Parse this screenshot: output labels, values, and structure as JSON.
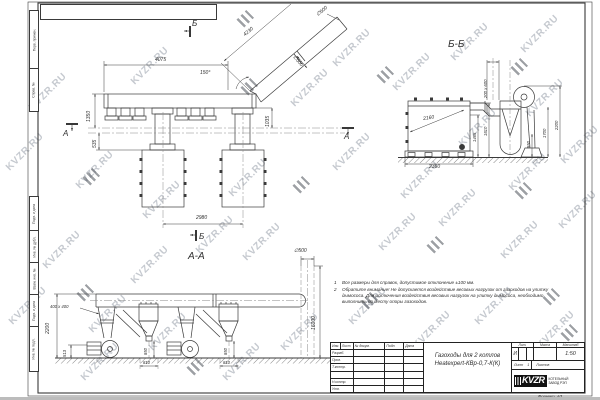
{
  "watermark": {
    "text": "KVZR.RU",
    "color": "#b7bcc4",
    "positions": [
      [
        48,
        92
      ],
      [
        25,
        152
      ],
      [
        95,
        170
      ],
      [
        62,
        250
      ],
      [
        28,
        306
      ],
      [
        108,
        314
      ],
      [
        162,
        200
      ],
      [
        150,
        265
      ],
      [
        215,
        235
      ],
      [
        150,
        66
      ],
      [
        248,
        178
      ],
      [
        262,
        242
      ],
      [
        310,
        88
      ],
      [
        352,
        48
      ],
      [
        412,
        72
      ],
      [
        470,
        42
      ],
      [
        540,
        34
      ],
      [
        352,
        152
      ],
      [
        420,
        180
      ],
      [
        478,
        128
      ],
      [
        545,
        98
      ],
      [
        528,
        172
      ],
      [
        580,
        145
      ],
      [
        398,
        232
      ],
      [
        458,
        208
      ],
      [
        520,
        240
      ],
      [
        578,
        210
      ],
      [
        300,
        332
      ],
      [
        368,
        306
      ],
      [
        432,
        330
      ],
      [
        494,
        306
      ],
      [
        556,
        330
      ],
      [
        242,
        362
      ],
      [
        168,
        332
      ],
      [
        100,
        362
      ]
    ]
  },
  "stamps": {
    "positions": [
      [
        250,
        86
      ],
      [
        386,
        74
      ],
      [
        520,
        66
      ],
      [
        92,
        176
      ],
      [
        302,
        184
      ],
      [
        524,
        190
      ],
      [
        436,
        244
      ],
      [
        86,
        292
      ],
      [
        370,
        300
      ],
      [
        552,
        296
      ],
      [
        196,
        366
      ],
      [
        440,
        352
      ],
      [
        570,
        332
      ],
      [
        246,
        18
      ]
    ]
  },
  "frame": {
    "margin_boxes": [
      {
        "text": "Перв. примен.",
        "top": 10,
        "h": 58
      },
      {
        "text": "Справ. №",
        "top": 68,
        "h": 42
      },
      {
        "text": "Подп. и дата",
        "top": 196,
        "h": 34
      },
      {
        "text": "Инв. № дубл.",
        "top": 230,
        "h": 32
      },
      {
        "text": "Взам. инв. №",
        "top": 262,
        "h": 32
      },
      {
        "text": "Подп. и дата",
        "top": 294,
        "h": 32
      },
      {
        "text": "Инв. № подл.",
        "top": 326,
        "h": 44
      }
    ]
  },
  "labels": [
    {
      "t": "Б",
      "x": 192,
      "y": 20,
      "s": 8,
      "n": "section-marker-b-top"
    },
    {
      "t": "Б",
      "x": 199,
      "y": 233,
      "s": 8,
      "n": "section-marker-b-bottom"
    },
    {
      "t": "А",
      "x": 63,
      "y": 130,
      "s": 8,
      "n": "section-marker-a-left"
    },
    {
      "t": "А",
      "x": 344,
      "y": 133,
      "s": 8,
      "n": "section-marker-a-right"
    },
    {
      "t": "4075",
      "x": 155,
      "y": 58,
      "s": 5
    },
    {
      "t": "4230",
      "x": 243,
      "y": 34,
      "s": 5,
      "r": -40
    },
    {
      "t": "∅500",
      "x": 316,
      "y": 14,
      "s": 5,
      "r": -40
    },
    {
      "t": "∅500",
      "x": 295,
      "y": 55,
      "s": 5,
      "r": 49
    },
    {
      "t": "150°",
      "x": 200,
      "y": 71,
      "s": 5
    },
    {
      "t": "1350",
      "x": 87,
      "y": 122,
      "s": 5,
      "r": -90
    },
    {
      "t": "535",
      "x": 93,
      "y": 148,
      "s": 5,
      "r": -90
    },
    {
      "t": "1035",
      "x": 266,
      "y": 127,
      "s": 5,
      "r": -90
    },
    {
      "t": "2980",
      "x": 196,
      "y": 216,
      "s": 5
    },
    {
      "t": "Б-Б",
      "x": 448,
      "y": 40,
      "s": 10,
      "n": "view-title-bb"
    },
    {
      "t": "200 х 600",
      "x": 484,
      "y": 98,
      "s": 4.2,
      "r": -90
    },
    {
      "t": "2160",
      "x": 423,
      "y": 117,
      "s": 5,
      "r": -8
    },
    {
      "t": "2360",
      "x": 429,
      "y": 165,
      "s": 5
    },
    {
      "t": "1465",
      "x": 473,
      "y": 142,
      "s": 4.2,
      "r": -90
    },
    {
      "t": "1810",
      "x": 484,
      "y": 136,
      "s": 4.2,
      "r": -90
    },
    {
      "t": "850",
      "x": 527,
      "y": 148,
      "s": 4.2,
      "r": -90
    },
    {
      "t": "1700",
      "x": 543,
      "y": 138,
      "s": 4.2,
      "r": -90
    },
    {
      "t": "2200",
      "x": 555,
      "y": 130,
      "s": 4.2,
      "r": -90
    },
    {
      "t": "А-А",
      "x": 188,
      "y": 252,
      "s": 10,
      "n": "view-title-aa"
    },
    {
      "t": "∅500",
      "x": 294,
      "y": 249,
      "s": 5
    },
    {
      "t": "16000",
      "x": 312,
      "y": 330,
      "s": 5,
      "r": -90
    },
    {
      "t": "400 х 400",
      "x": 50,
      "y": 305,
      "s": 4.2
    },
    {
      "t": "2200",
      "x": 46,
      "y": 334,
      "s": 5,
      "r": -90
    },
    {
      "t": "513",
      "x": 63,
      "y": 357,
      "s": 4.2,
      "r": -90
    },
    {
      "t": "850",
      "x": 144,
      "y": 355,
      "s": 4.2,
      "r": -90
    },
    {
      "t": "810",
      "x": 143,
      "y": 361,
      "s": 4.2
    },
    {
      "t": "850",
      "x": 224,
      "y": 355,
      "s": 4.2,
      "r": -90
    },
    {
      "t": "810",
      "x": 223,
      "y": 361,
      "s": 4.2
    }
  ],
  "notes": {
    "items": [
      {
        "num": "1",
        "text": "Все размеры для справок, допустимое отклонение ±100 мм."
      },
      {
        "num": "2",
        "text": "Обратите внимание! Не допускается воздействие весовых нагрузок от газоходов на улитку дымососа. Для исключения воздействия весовых нагрузок на улитку дымососа, необходимо выполнить по месту опоры газоходов."
      }
    ]
  },
  "title_block": {
    "cols": [
      "Изм.",
      "Лист",
      "№ докум.",
      "Подп.",
      "Дата"
    ],
    "rows": [
      "Разраб.",
      "Пров.",
      "Т.контр.",
      "",
      "Н.контр.",
      "Утв."
    ],
    "title_line1": "Газоходы для 2 котлов",
    "title_line2": "Heatexpert-КВр-0,7-К(К)",
    "lit_label": "Лит.",
    "lit_value": "И",
    "mass_label": "Масса",
    "scale_label": "Масштаб",
    "scale_value": "1:50",
    "sheet_label": "Лист",
    "sheet_value": "1",
    "sheets_label": "Листов",
    "logo_text": "KVZR",
    "company": [
      "КОТЕЛЬНЫЙ",
      "ЗАВОД РЭП"
    ],
    "format_label": "Формат",
    "format_value": "А3"
  }
}
